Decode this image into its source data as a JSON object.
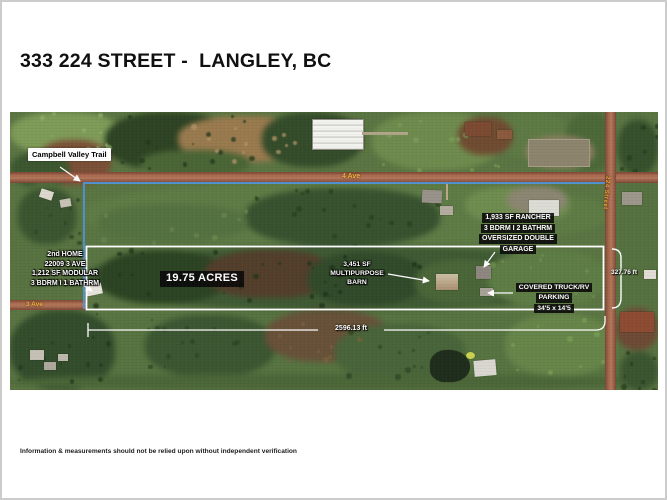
{
  "page": {
    "title": "333 224 STREET -  LANGLEY, BC",
    "disclaimer": "Information & measurements should not be relied upon without independent verification"
  },
  "map": {
    "trail_label": "Campbell Valley Trail",
    "acreage": "19.75 ACRES",
    "roads": {
      "ave4": "4 Ave",
      "ave3": "3 Ave",
      "st224": "224 Street"
    },
    "second_home": {
      "l1": "2nd HOME",
      "l2": "22009  3 AVE",
      "l3": "1,212 SF MODULAR",
      "l4": "3 BDRM  I  1 BATHRM"
    },
    "barn": {
      "l1": "3,451 SF",
      "l2": "MULTIPURPOSE",
      "l3": "BARN"
    },
    "rancher": {
      "l1": "1,933 SF  RANCHER",
      "l2": "3 BDRM  I  2 BATHRM",
      "l3": "OVERSIZED DOUBLE",
      "l4": "GARAGE"
    },
    "parking": {
      "l1": "COVERED TRUCK/RV",
      "l2": "PARKING",
      "l3": "34'5 x 14'5"
    },
    "measurements": {
      "frontage": "2596.13 ft",
      "depth": "327.76 ft"
    },
    "colors": {
      "boundary_blue": "#4f93d8",
      "parcel_outline": "#ffffff",
      "road_label_yellow": "#f0b13c",
      "measure_white": "#ffffff"
    }
  }
}
